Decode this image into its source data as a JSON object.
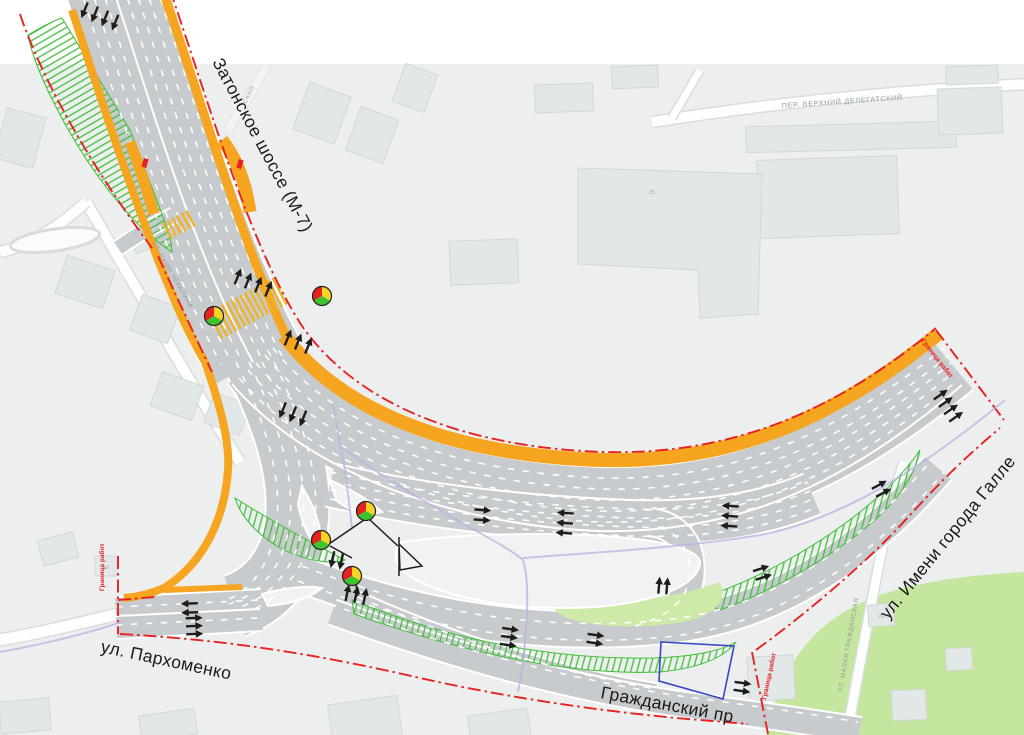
{
  "colors": {
    "top_band": "#ffffff",
    "map_bg": "#edefef",
    "building": "#e2e7e8",
    "building_border": "#d2d8da",
    "bg_road": "#fdfefe",
    "bg_road_casing": "#d9dddf",
    "road": "#c7cbcd",
    "island": "#f1f3f3",
    "median_orange": "#f5a51f",
    "boundary_red": "#e62222",
    "hatch_green": "#3fbe37",
    "lawn_green": "#cdeaa8",
    "lawn_green_big": "#c5e69e",
    "utility_lavender": "#b7b3e0",
    "parcel_blue": "#3646c4",
    "marking_black": "#1d1d1d",
    "label_dark": "#1a1a1a",
    "label_gray": "#939a9e",
    "signal_red": "#e42320",
    "signal_yellow": "#f5d424",
    "signal_green": "#3fc42d",
    "crosswalk_yellow": "#edb32b"
  },
  "labels": {
    "main_roads": [
      {
        "name": "zatonskoye-shosse",
        "text": "Затонское шоссе (М-7)"
      },
      {
        "name": "galle-street",
        "text": "ул. Имени города Галле"
      },
      {
        "name": "parkhomenko-street",
        "text": "ул. Пархоменко"
      },
      {
        "name": "grazhdansky-prospekt",
        "text": "Гражданский пр"
      }
    ],
    "background_streets": [
      {
        "name": "verkhny-delegatsky",
        "text": "ПЕР. ВЕРХНИЙ ДЕЛЕГАТСКИЙ"
      },
      {
        "name": "sashi-chekalina",
        "text": "УЛ. САШИ ЧЕКАЛИНА"
      },
      {
        "name": "malaya-grazhdanskaya",
        "text": "УЛ. МАЛАЯ ГРАЖДАНСКАЯ"
      },
      {
        "name": "street-fragment",
        "text": "СКАЯ"
      }
    ],
    "work_boundary": {
      "text": "Граница работ"
    },
    "building_numbers": [
      {
        "text": "16"
      },
      {
        "text": "25"
      },
      {
        "text": "26"
      }
    ]
  },
  "features": {
    "traffic_signals": {
      "icon": "traffic-light-icon",
      "positions": [
        [
          214,
          316
        ],
        [
          322,
          296
        ],
        [
          366,
          511
        ],
        [
          321,
          540
        ],
        [
          352,
          576
        ]
      ]
    },
    "lane_arrow_clusters": [
      [
        100,
        16,
        112,
        4,
        11
      ],
      [
        253,
        283,
        -68,
        4,
        11
      ],
      [
        298,
        342,
        -68,
        3,
        11
      ],
      [
        293,
        414,
        112,
        3,
        11
      ],
      [
        190,
        608,
        178,
        2,
        9
      ],
      [
        194,
        626,
        -2,
        3,
        8
      ],
      [
        356,
        595,
        -78,
        3,
        9
      ],
      [
        337,
        560,
        102,
        2,
        9
      ],
      [
        482,
        515,
        4,
        2,
        10
      ],
      [
        565,
        523,
        184,
        3,
        10
      ],
      [
        730,
        516,
        184,
        3,
        10
      ],
      [
        881,
        489,
        -28,
        2,
        9
      ],
      [
        948,
        406,
        -35,
        4,
        9
      ],
      [
        762,
        573,
        -18,
        2,
        9
      ],
      [
        595,
        639,
        8,
        2,
        8
      ],
      [
        509,
        637,
        8,
        3,
        8
      ],
      [
        663,
        586,
        -85,
        2,
        8
      ],
      [
        742,
        687,
        8,
        2,
        8
      ]
    ],
    "crosswalks": [
      [
        248,
        308,
        62,
        30,
        74
      ],
      [
        180,
        224,
        62,
        18,
        26
      ]
    ],
    "bus_stop_marks": [
      [
        145,
        163
      ],
      [
        240,
        164
      ]
    ]
  }
}
